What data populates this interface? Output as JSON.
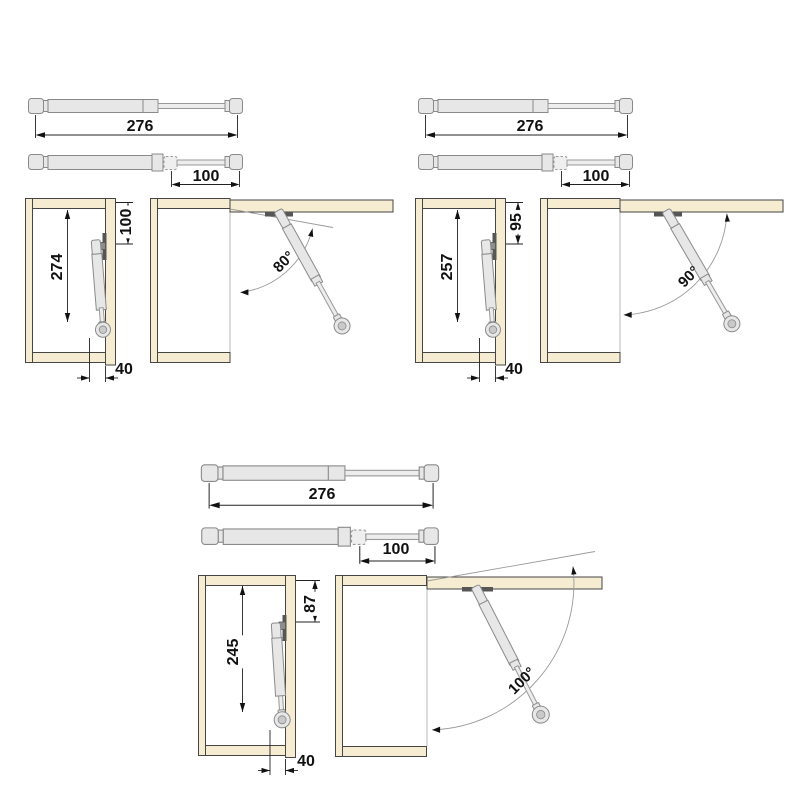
{
  "diagram_title": "gas-strut lift-up door mounting dimensions",
  "colors": {
    "wood": "#f5ecd2",
    "outline": "#454545",
    "strut_fill": "#e7e7e7",
    "strut_stroke": "#8a8a8a",
    "dimension_line": "#222222",
    "arc_line": "#9a9a9a"
  },
  "figures": [
    {
      "name": "opening-80",
      "strut_total_length": "276",
      "strut_rod_length": "100",
      "inner_mount_depth": "274",
      "door_mount_offset": "100",
      "bottom_mount_offset": "40",
      "opening_angle": "80°"
    },
    {
      "name": "opening-90",
      "strut_total_length": "276",
      "strut_rod_length": "100",
      "inner_mount_depth": "257",
      "door_mount_offset": "95",
      "bottom_mount_offset": "40",
      "opening_angle": "90°"
    },
    {
      "name": "opening-100",
      "strut_total_length": "276",
      "strut_rod_length": "100",
      "inner_mount_depth": "245",
      "door_mount_offset": "87",
      "bottom_mount_offset": "40",
      "opening_angle": "100°"
    }
  ]
}
